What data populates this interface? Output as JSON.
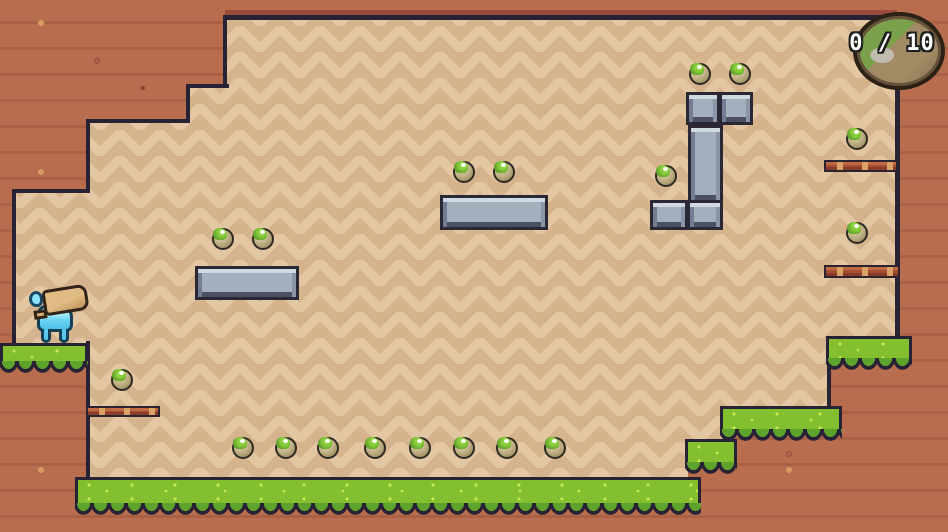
{
  "hud": {
    "counter": {
      "collected": "0",
      "separator": "/",
      "total": "10",
      "display": "0 / 10",
      "badge_icon": "mossy-rock-badge"
    }
  },
  "scene": {
    "colors": {
      "outer_ground": "#b76d4e",
      "cavity_light": "#e3c7a2",
      "cavity_dark": "#d5b38c",
      "outline": "#272334",
      "edge_accent": "#9c4b3a",
      "grass_top": "#84bf30",
      "grass_scallop": "#5ea32b",
      "steel": "#a3afbc",
      "wood_bar": "#a64d33",
      "fruit_body": "#ab9b70",
      "fruit_moss": "#5fa22a",
      "player_blue": "#6fd4f4",
      "sack_tan": "#d8b27c"
    },
    "player": {
      "name": "blue-creature-with-sack",
      "x": 28,
      "y": 286
    },
    "apples": [
      [
        700,
        74
      ],
      [
        740,
        74
      ],
      [
        666,
        176
      ],
      [
        464,
        172
      ],
      [
        504,
        172
      ],
      [
        857,
        139
      ],
      [
        857,
        233
      ],
      [
        223,
        239
      ],
      [
        263,
        239
      ],
      [
        122,
        380
      ],
      [
        243,
        448
      ],
      [
        286,
        448
      ],
      [
        328,
        448
      ],
      [
        375,
        448
      ],
      [
        420,
        448
      ],
      [
        464,
        448
      ],
      [
        507,
        448
      ],
      [
        555,
        448
      ]
    ],
    "grass_platforms": [
      {
        "name": "left-ledge",
        "x": 0,
        "y": 343,
        "w": 88,
        "h": 30
      },
      {
        "name": "bottom-main",
        "x": 75,
        "y": 477,
        "w": 626,
        "h": 38
      },
      {
        "name": "step-small",
        "x": 685,
        "y": 439,
        "w": 52,
        "h": 35
      },
      {
        "name": "step-mid",
        "x": 720,
        "y": 406,
        "w": 122,
        "h": 35
      },
      {
        "name": "right-shelf",
        "x": 826,
        "y": 336,
        "w": 86,
        "h": 34
      }
    ],
    "stone_blocks": [
      {
        "x": 195,
        "y": 266,
        "w": 104,
        "h": 34
      },
      {
        "x": 440,
        "y": 195,
        "w": 108,
        "h": 35
      },
      {
        "x": 686,
        "y": 92,
        "w": 34,
        "h": 33
      },
      {
        "x": 719,
        "y": 92,
        "w": 34,
        "h": 33
      },
      {
        "x": 688,
        "y": 125,
        "w": 35,
        "h": 78
      },
      {
        "x": 650,
        "y": 200,
        "w": 38,
        "h": 30
      },
      {
        "x": 687,
        "y": 200,
        "w": 36,
        "h": 30
      }
    ],
    "wooden_bars": [
      {
        "x": 86,
        "y": 406,
        "w": 74,
        "h": 11
      },
      {
        "x": 824,
        "y": 160,
        "w": 74,
        "h": 12
      },
      {
        "x": 824,
        "y": 265,
        "w": 76,
        "h": 13
      }
    ]
  }
}
